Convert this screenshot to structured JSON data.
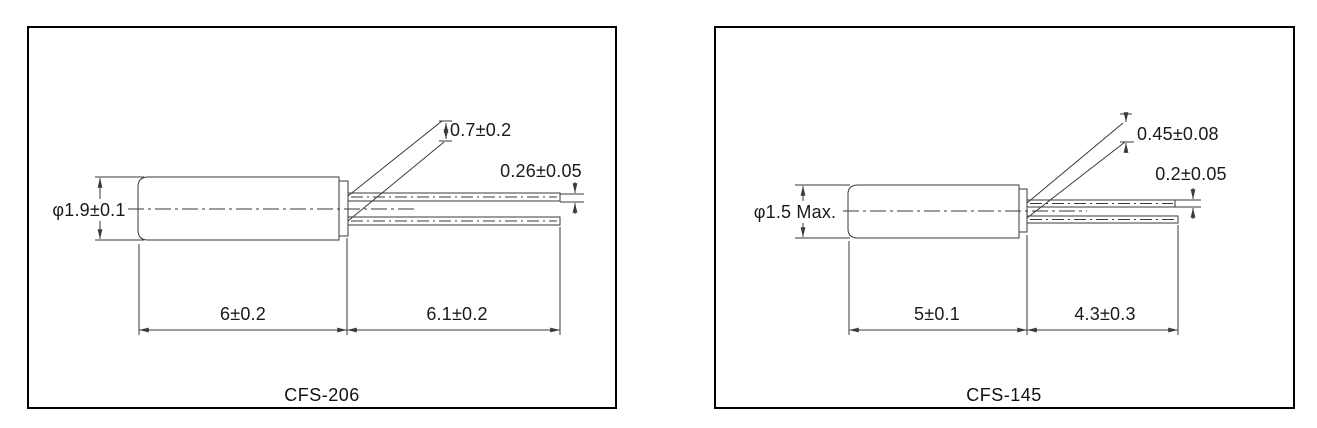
{
  "drawings": [
    {
      "model": "CFS-206",
      "dimensions": {
        "body_diameter": "φ1.9±0.1",
        "lead_tip_spacing": "0.7±0.2",
        "lead_diameter": "0.26±0.05",
        "body_length": "6±0.2",
        "lead_length": "6.1±0.2"
      }
    },
    {
      "model": "CFS-145",
      "dimensions": {
        "body_diameter": "φ1.5 Max.",
        "lead_tip_spacing": "0.45±0.08",
        "lead_diameter": "0.2±0.05",
        "body_length": "5±0.1",
        "lead_length": "4.3±0.3"
      }
    }
  ],
  "colors": {
    "line": "#3a3a3a",
    "panel_border": "#000000",
    "text": "#1a1a1a",
    "background": "#ffffff"
  }
}
